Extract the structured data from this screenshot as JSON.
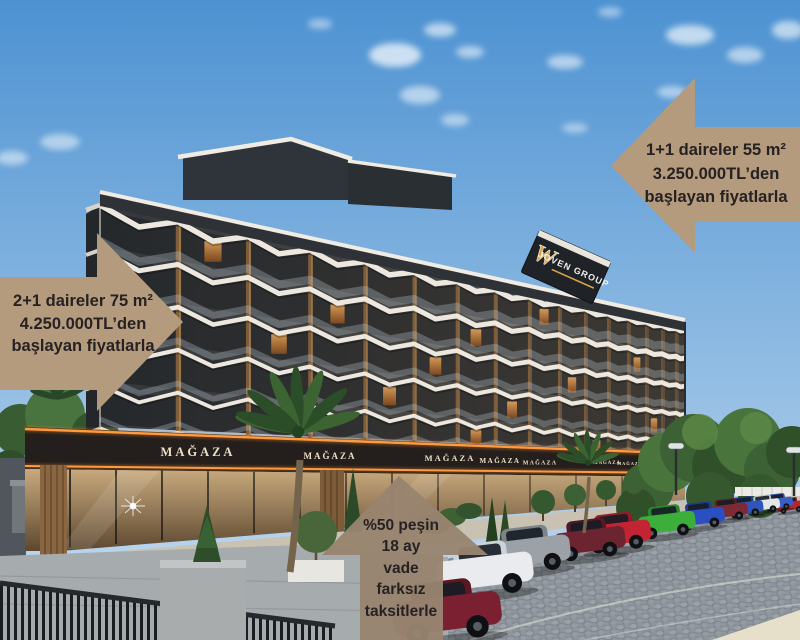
{
  "callouts": {
    "top_right": {
      "lines": [
        "1+1 daireler 55 m²",
        "3.250.000TL’den",
        "başlayan fiyatlarla"
      ]
    },
    "left": {
      "lines": [
        "2+1 daireler 75 m²",
        "4.250.000TL’den",
        "başlayan fiyatlarla"
      ]
    },
    "bottom": {
      "lines": [
        "%50 peşin",
        "18 ay",
        "vade",
        "farksız",
        "taksitlerle"
      ]
    }
  },
  "building": {
    "brand": {
      "monogram": "W",
      "name": "JOVEN GROUP"
    },
    "store_signs": [
      "MAĞAZA",
      "MAĞAZA",
      "MAĞAZA",
      "MAĞAZA",
      "MAĞAZA",
      "MAĞAZA",
      "MAĞAZA",
      "MAĞAZA"
    ]
  },
  "colors": {
    "callout_tan": "#b59b7d",
    "callout_bottom": "#98846f",
    "callout_text": "#262123",
    "led_orange": "#ff8a28",
    "brand_gold": "#d9a646"
  }
}
